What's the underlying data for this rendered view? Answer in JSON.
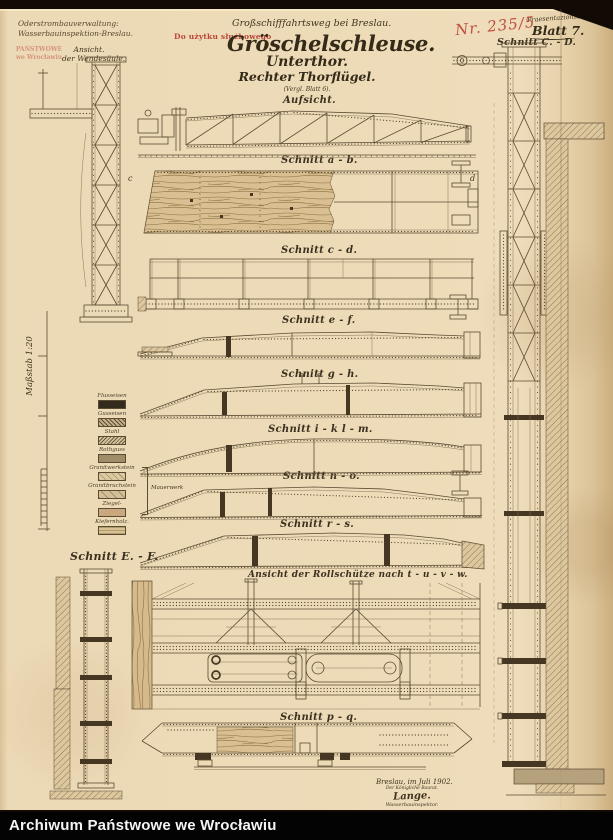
{
  "colors": {
    "paper": "#eedcba",
    "ink": "#4a3d2c",
    "stamp_red": "#b5372b",
    "bar_bg": "#000000",
    "bar_text": "#ffffff"
  },
  "archive_bar": {
    "text": "Archiwum Państwowe we Wrocławiu"
  },
  "header": {
    "org_line1": "Oderstrombauverwaltung:",
    "org_line2": "Wasserbauinspektion-Breslau.",
    "usage_stamp": "Do użytku służbowego",
    "archive_stamp_line1": "PAŃSTWOWE",
    "archive_stamp_line2": "we Wrocławiu",
    "supertitle": "Großschifffahrtsweg bei Breslau.",
    "title": "Gröschelschleuse.",
    "subtitle1": "Unterthor.",
    "subtitle2": "Rechter Thorflügel.",
    "note": "(Vergl. Blatt 6).",
    "doc_type": "Praesentazionszeichnung.",
    "sheet_no": "Blatt 7.",
    "handwritten_no": "Nr. 235/5"
  },
  "left_view": {
    "line1": "Ansicht.",
    "line2": "der Wendesäule."
  },
  "scale_label": "Maßstab 1:20",
  "legend": {
    "items": [
      {
        "label": "Flusseisen"
      },
      {
        "label": "Gusseisen"
      },
      {
        "label": "Stahl"
      },
      {
        "label": "Rothguss"
      },
      {
        "label": "Granitwerkstein"
      },
      {
        "label": "Granitbruchstein"
      },
      {
        "label": "Ziegel-"
      },
      {
        "label": "Kiefernholz."
      }
    ],
    "group_label": "Mauerwerk"
  },
  "sections": [
    {
      "label": "Aufsicht."
    },
    {
      "label": "Schnitt a - b."
    },
    {
      "label": "Schnitt c - d."
    },
    {
      "label": "Schnitt e - f."
    },
    {
      "label": "Schnitt g - h."
    },
    {
      "label": "Schnitt i - k  l - m."
    },
    {
      "label": "Schnitt n - o."
    },
    {
      "label": "Schnitt r - s."
    },
    {
      "label": "Ansicht der Rollschütze nach t - u - v - w."
    },
    {
      "label": "Schnitt p - q."
    }
  ],
  "side_sections": {
    "right": "Schnitt C. - D.",
    "left": "Schnitt E. - F."
  },
  "plan_marks": {
    "left": "c",
    "right": "d"
  },
  "footer": {
    "place_date": "Breslau, im Juli 1902.",
    "office": "Der Königliche Baurat.",
    "signature": "Lange.",
    "role": "Wasserbauinspektor."
  }
}
